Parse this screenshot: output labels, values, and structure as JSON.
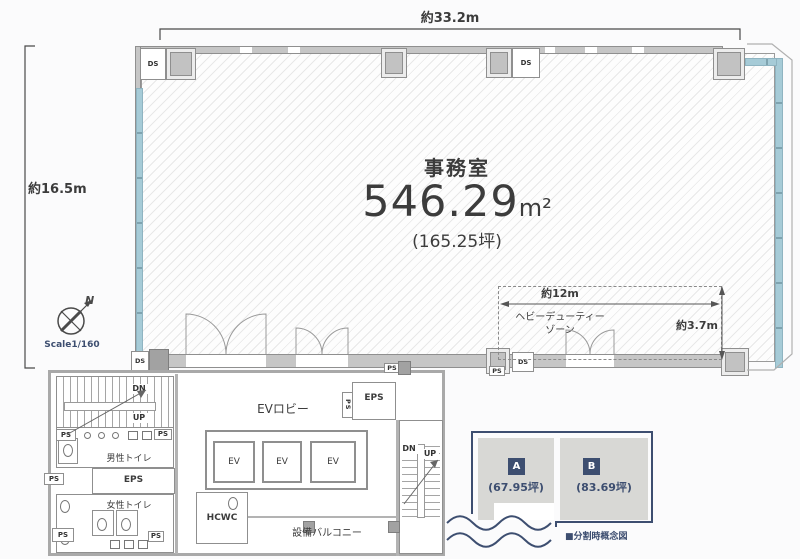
{
  "plan": {
    "dim_top": "約33.2m",
    "dim_left": "約16.5m",
    "office": {
      "title": "事務室",
      "area_value": "546.29",
      "area_unit": "m²",
      "area_tsubo": "(165.25坪)"
    },
    "heavy_zone": {
      "label_line1": "ヘビーデューティー",
      "label_line2": "ゾーン",
      "dim_width": "約12m",
      "dim_depth": "約3.7m"
    },
    "compass": {
      "north": "N",
      "scale": "Scale1/160"
    }
  },
  "rooms": {
    "ev_lobby": "EVロビー",
    "elevator": "EV",
    "eps": "EPS",
    "mens_toilet": "男性トイレ",
    "womens_toilet": "女性トイレ",
    "hcwc": "HCWC",
    "balcony": "設備バルコニー",
    "stair_down": "DN",
    "stair_up": "UP"
  },
  "shafts": {
    "ps": "PS",
    "ds": "DS"
  },
  "concept": {
    "title": "■分割時概念図",
    "units": [
      {
        "id": "A",
        "area": "(67.95坪)"
      },
      {
        "id": "B",
        "area": "(83.69坪)"
      }
    ]
  },
  "colors": {
    "window_band": "#a6cbd7",
    "navy": "#3d4e70",
    "wall_gray": "#c6c6c6",
    "text": "#3c3c3c"
  }
}
